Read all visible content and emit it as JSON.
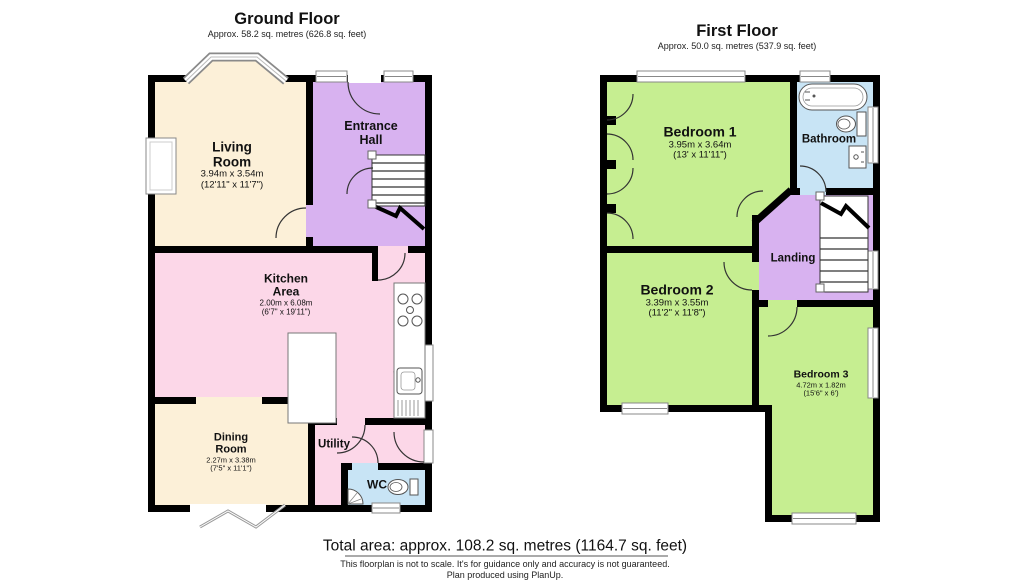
{
  "ground_floor": {
    "title": "Ground Floor",
    "subtitle": "Approx. 58.2 sq. metres (626.8 sq. feet)",
    "rooms": {
      "living_room": {
        "name": "Living Room",
        "dims_metric": "3.94m x 3.54m",
        "dims_imperial": "(12'11\" x 11'7\")"
      },
      "entrance_hall": {
        "name": "Entrance Hall"
      },
      "kitchen_area": {
        "name": "Kitchen Area",
        "dims_metric": "2.00m x 6.08m",
        "dims_imperial": "(6'7\" x 19'11\")"
      },
      "dining_room": {
        "name": "Dining Room",
        "dims_metric": "2.27m x 3.38m",
        "dims_imperial": "(7'5\" x 11'1\")"
      },
      "utility": {
        "name": "Utility"
      },
      "wc": {
        "name": "WC"
      }
    }
  },
  "first_floor": {
    "title": "First Floor",
    "subtitle": "Approx. 50.0 sq. metres (537.9 sq. feet)",
    "rooms": {
      "bedroom_1": {
        "name": "Bedroom 1",
        "dims_metric": "3.95m x 3.64m",
        "dims_imperial": "(13' x 11'11\")"
      },
      "bathroom": {
        "name": "Bathroom"
      },
      "landing": {
        "name": "Landing"
      },
      "bedroom_2": {
        "name": "Bedroom 2",
        "dims_metric": "3.39m x 3.55m",
        "dims_imperial": "(11'2\" x 11'8\")"
      },
      "bedroom_3": {
        "name": "Bedroom 3",
        "dims_metric": "4.72m x 1.82m",
        "dims_imperial": "(15'6\" x 6')"
      }
    }
  },
  "footer": {
    "total_area": "Total area: approx. 108.2 sq. metres (1164.7 sq. feet)",
    "disclaimer_line1": "This floorplan is not to scale. It's for guidance only and accuracy is not guaranteed.",
    "disclaimer_line2": "Plan produced using PlanUp."
  },
  "room_palette": {
    "reception_cream": "#fcf0d8",
    "hall_lavender": "#d8b2f0",
    "kitchen_pink": "#fcd7e8",
    "wet_room_blue": "#c8e4f5",
    "bedroom_green": "#c6ee91",
    "wall_black": "#000000"
  }
}
